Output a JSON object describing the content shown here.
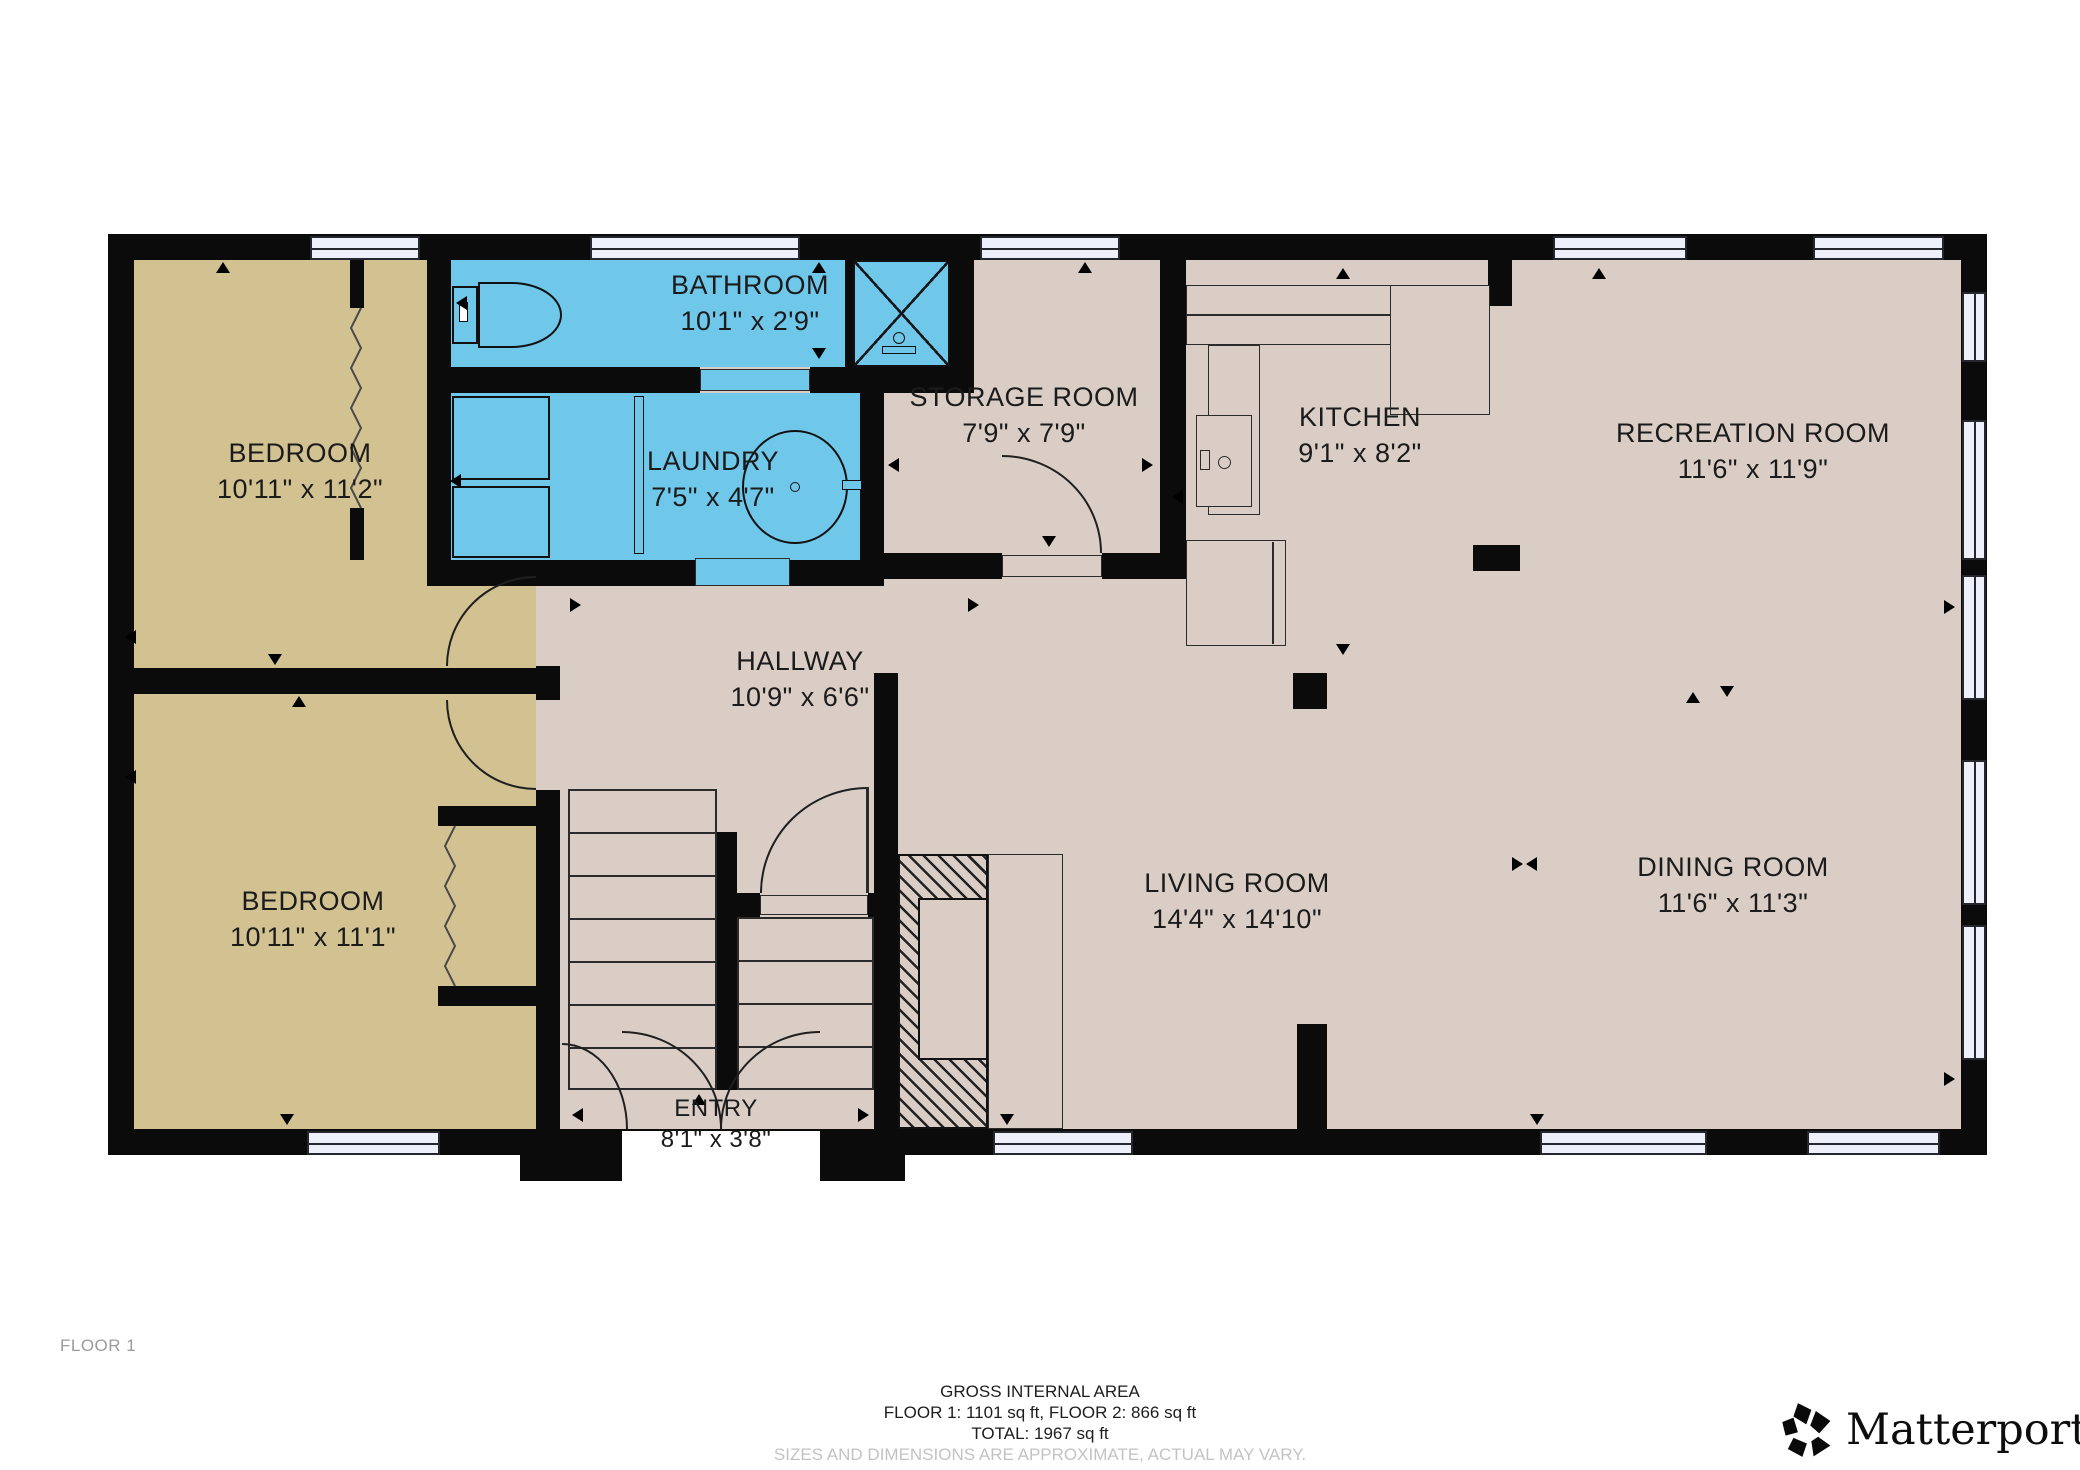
{
  "plan": {
    "floor_label": "FLOOR 1",
    "rooms": [
      {
        "id": "bedroom-1",
        "name": "BEDROOM",
        "dims": "10'11\" x 11'2\""
      },
      {
        "id": "bedroom-2",
        "name": "BEDROOM",
        "dims": "10'11\" x 11'1\""
      },
      {
        "id": "bathroom",
        "name": "BATHROOM",
        "dims": "10'1\" x 2'9\""
      },
      {
        "id": "laundry",
        "name": "LAUNDRY",
        "dims": "7'5\" x 4'7\""
      },
      {
        "id": "storage",
        "name": "STORAGE ROOM",
        "dims": "7'9\" x 7'9\""
      },
      {
        "id": "kitchen",
        "name": "KITCHEN",
        "dims": "9'1\" x 8'2\""
      },
      {
        "id": "recreation",
        "name": "RECREATION ROOM",
        "dims": "11'6\" x 11'9\""
      },
      {
        "id": "hallway",
        "name": "HALLWAY",
        "dims": "10'9\" x 6'6\""
      },
      {
        "id": "living",
        "name": "LIVING ROOM",
        "dims": "14'4\" x 14'10\""
      },
      {
        "id": "dining",
        "name": "DINING ROOM",
        "dims": "11'6\" x 11'3\""
      },
      {
        "id": "entry",
        "name": "ENTRY",
        "dims": "8'1\" x 3'8\""
      }
    ],
    "colors": {
      "floor": "#DACDC5",
      "tan": "#D2C292",
      "wet": "#6FC7EA",
      "wall": "#0B0B0B",
      "win": "#EDEFFB"
    }
  },
  "footer": {
    "area_title": "GROSS INTERNAL AREA",
    "area_line": "FLOOR 1: 1101 sq ft, FLOOR 2: 866 sq ft",
    "total_line": "TOTAL: 1967 sq ft",
    "disclaimer": "SIZES AND DIMENSIONS ARE APPROXIMATE, ACTUAL MAY VARY.",
    "brand": "Matterport",
    "brand_reg": "®"
  }
}
